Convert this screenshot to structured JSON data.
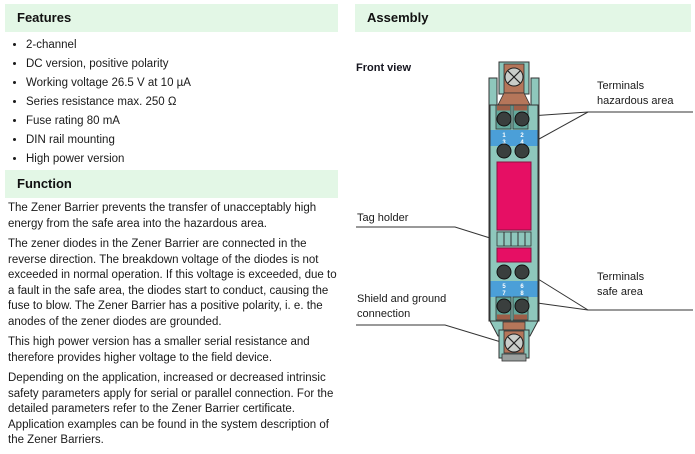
{
  "colors": {
    "header_bar_green": "#e3f7e6",
    "device_teal": "#8ec7bc",
    "device_teal_dark": "#63a89c",
    "label_magenta": "#e60f64",
    "terminal_band_blue": "#4b9fd8",
    "copper": "#b5765a",
    "screw_gray": "#c9cdc9",
    "terminal_screw_dark": "#3a3f3e",
    "text": "#1a1a1a"
  },
  "features": {
    "title": "Features",
    "items": [
      "2-channel",
      "DC version, positive polarity",
      "Working voltage 26.5 V at 10 µA",
      "Series resistance max. 250 Ω",
      "Fuse rating 80 mA",
      "DIN rail mounting",
      "High power version"
    ]
  },
  "function": {
    "title": "Function",
    "paragraphs": [
      "The Zener Barrier prevents the transfer of unacceptably high energy from the safe area into the hazardous area.",
      "The zener diodes in the Zener Barrier are connected in the reverse direction. The breakdown voltage of the diodes is not exceeded in normal operation. If this voltage is exceeded, due to a fault in the safe area, the diodes start to conduct, causing the fuse to blow. The Zener Barrier has a positive polarity, i. e. the anodes of the zener diodes are grounded.",
      "This high power version has a smaller serial resistance and therefore provides higher voltage to the field device.",
      "Depending on the application, increased or decreased intrinsic safety parameters apply for serial or parallel connection. For the detailed parameters refer to the Zener Barrier certificate. Application examples can be found in the system description of the Zener Barriers."
    ]
  },
  "assembly": {
    "title": "Assembly",
    "front_view_label": "Front view",
    "labels": {
      "tag_holder": "Tag holder",
      "shield_ground": "Shield and ground\nconnection",
      "terminals_hazardous": "Terminals\nhazardous area",
      "terminals_safe": "Terminals\nsafe area"
    },
    "terminal_numbers": {
      "hazardous": [
        "1",
        "3",
        "2",
        "4"
      ],
      "safe": [
        "5",
        "7",
        "6",
        "8"
      ]
    }
  }
}
